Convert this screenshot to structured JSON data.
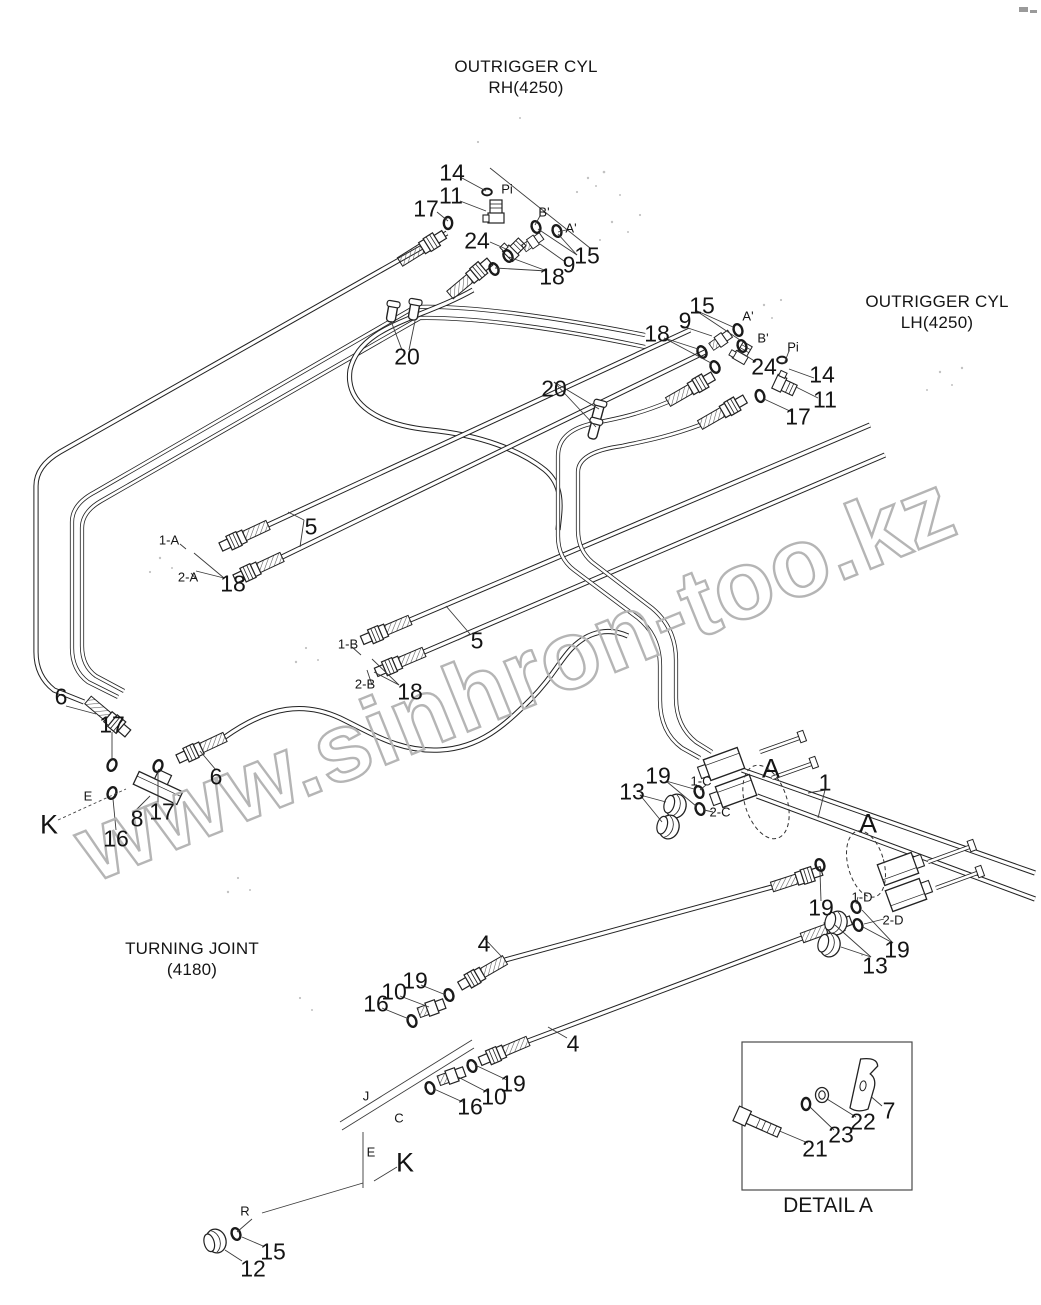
{
  "titles": {
    "outrigger_rh": {
      "line1": "OUTRIGGER CYL",
      "line2": "RH(4250)"
    },
    "outrigger_lh": {
      "line1": "OUTRIGGER CYL",
      "line2": "LH(4250)"
    },
    "turning_joint": {
      "line1": "TURNING JOINT",
      "line2": "(4180)"
    },
    "detail_a": "DETAIL A"
  },
  "watermark": {
    "text": "www.sinhron-too.kz",
    "color": "#b5b5b5"
  },
  "colors": {
    "line": "#222222",
    "label": "#141414",
    "background": "#ffffff"
  },
  "labels": [
    {
      "text": "14",
      "x": 452,
      "y": 173,
      "size": "lg"
    },
    {
      "text": "Pi",
      "x": 507,
      "y": 189,
      "size": "sm"
    },
    {
      "text": "11",
      "x": 451,
      "y": 196,
      "size": "lg"
    },
    {
      "text": "17",
      "x": 426,
      "y": 209,
      "size": "lg"
    },
    {
      "text": "B'",
      "x": 544,
      "y": 212,
      "size": "sm"
    },
    {
      "text": "A'",
      "x": 571,
      "y": 228,
      "size": "sm"
    },
    {
      "text": "24",
      "x": 477,
      "y": 241,
      "size": "lg"
    },
    {
      "text": "15",
      "x": 587,
      "y": 256,
      "size": "lg"
    },
    {
      "text": "9",
      "x": 569,
      "y": 265,
      "size": "lg"
    },
    {
      "text": "18",
      "x": 552,
      "y": 277,
      "size": "lg"
    },
    {
      "text": "20",
      "x": 407,
      "y": 357,
      "size": "lg"
    },
    {
      "text": "15",
      "x": 702,
      "y": 306,
      "size": "lg"
    },
    {
      "text": "9",
      "x": 685,
      "y": 321,
      "size": "lg"
    },
    {
      "text": "A'",
      "x": 748,
      "y": 316,
      "size": "sm"
    },
    {
      "text": "18",
      "x": 657,
      "y": 334,
      "size": "lg"
    },
    {
      "text": "B'",
      "x": 763,
      "y": 338,
      "size": "sm"
    },
    {
      "text": "Pi",
      "x": 793,
      "y": 347,
      "size": "sm"
    },
    {
      "text": "24",
      "x": 764,
      "y": 367,
      "size": "lg"
    },
    {
      "text": "14",
      "x": 822,
      "y": 375,
      "size": "lg"
    },
    {
      "text": "11",
      "x": 825,
      "y": 400,
      "size": "lg"
    },
    {
      "text": "17",
      "x": 798,
      "y": 417,
      "size": "lg"
    },
    {
      "text": "20",
      "x": 554,
      "y": 389,
      "size": "lg"
    },
    {
      "text": "1-A",
      "x": 169,
      "y": 540,
      "size": "sm"
    },
    {
      "text": "2-A",
      "x": 188,
      "y": 577,
      "size": "sm"
    },
    {
      "text": "18",
      "x": 233,
      "y": 584,
      "size": "lg"
    },
    {
      "text": "5",
      "x": 311,
      "y": 527,
      "size": "lg"
    },
    {
      "text": "1-B",
      "x": 348,
      "y": 644,
      "size": "sm"
    },
    {
      "text": "2-B",
      "x": 365,
      "y": 684,
      "size": "sm"
    },
    {
      "text": "18",
      "x": 410,
      "y": 692,
      "size": "lg"
    },
    {
      "text": "5",
      "x": 477,
      "y": 641,
      "size": "lg"
    },
    {
      "text": "6",
      "x": 61,
      "y": 697,
      "size": "lg"
    },
    {
      "text": "17",
      "x": 112,
      "y": 725,
      "size": "lg"
    },
    {
      "text": "E",
      "x": 88,
      "y": 796,
      "size": "sm"
    },
    {
      "text": "K",
      "x": 49,
      "y": 825,
      "size": "xl"
    },
    {
      "text": "8",
      "x": 137,
      "y": 819,
      "size": "lg"
    },
    {
      "text": "16",
      "x": 116,
      "y": 839,
      "size": "lg"
    },
    {
      "text": "17",
      "x": 162,
      "y": 812,
      "size": "lg"
    },
    {
      "text": "6",
      "x": 216,
      "y": 777,
      "size": "lg"
    },
    {
      "text": "13",
      "x": 632,
      "y": 792,
      "size": "lg"
    },
    {
      "text": "19",
      "x": 658,
      "y": 776,
      "size": "lg"
    },
    {
      "text": "1-C",
      "x": 701,
      "y": 781,
      "size": "sm"
    },
    {
      "text": "2-C",
      "x": 720,
      "y": 812,
      "size": "sm"
    },
    {
      "text": "A",
      "x": 771,
      "y": 769,
      "size": "xl"
    },
    {
      "text": "1",
      "x": 825,
      "y": 783,
      "size": "lg"
    },
    {
      "text": "A",
      "x": 868,
      "y": 824,
      "size": "xl"
    },
    {
      "text": "19",
      "x": 821,
      "y": 908,
      "size": "lg"
    },
    {
      "text": "1-D",
      "x": 862,
      "y": 897,
      "size": "sm"
    },
    {
      "text": "2-D",
      "x": 893,
      "y": 920,
      "size": "sm"
    },
    {
      "text": "19",
      "x": 897,
      "y": 950,
      "size": "lg"
    },
    {
      "text": "13",
      "x": 875,
      "y": 966,
      "size": "lg"
    },
    {
      "text": "4",
      "x": 484,
      "y": 944,
      "size": "lg"
    },
    {
      "text": "19",
      "x": 415,
      "y": 981,
      "size": "lg"
    },
    {
      "text": "10",
      "x": 394,
      "y": 992,
      "size": "lg"
    },
    {
      "text": "16",
      "x": 376,
      "y": 1004,
      "size": "lg"
    },
    {
      "text": "4",
      "x": 573,
      "y": 1044,
      "size": "lg"
    },
    {
      "text": "19",
      "x": 513,
      "y": 1084,
      "size": "lg"
    },
    {
      "text": "10",
      "x": 494,
      "y": 1097,
      "size": "lg"
    },
    {
      "text": "16",
      "x": 470,
      "y": 1107,
      "size": "lg"
    },
    {
      "text": "J",
      "x": 366,
      "y": 1096,
      "size": "sm"
    },
    {
      "text": "C",
      "x": 399,
      "y": 1118,
      "size": "sm"
    },
    {
      "text": "E",
      "x": 371,
      "y": 1152,
      "size": "sm"
    },
    {
      "text": "K",
      "x": 405,
      "y": 1163,
      "size": "xl"
    },
    {
      "text": "R",
      "x": 245,
      "y": 1211,
      "size": "sm"
    },
    {
      "text": "15",
      "x": 273,
      "y": 1252,
      "size": "lg"
    },
    {
      "text": "12",
      "x": 253,
      "y": 1269,
      "size": "lg"
    },
    {
      "text": "7",
      "x": 889,
      "y": 1111,
      "size": "lg"
    },
    {
      "text": "22",
      "x": 863,
      "y": 1122,
      "size": "lg"
    },
    {
      "text": "23",
      "x": 841,
      "y": 1135,
      "size": "lg"
    },
    {
      "text": "21",
      "x": 815,
      "y": 1149,
      "size": "lg"
    }
  ]
}
